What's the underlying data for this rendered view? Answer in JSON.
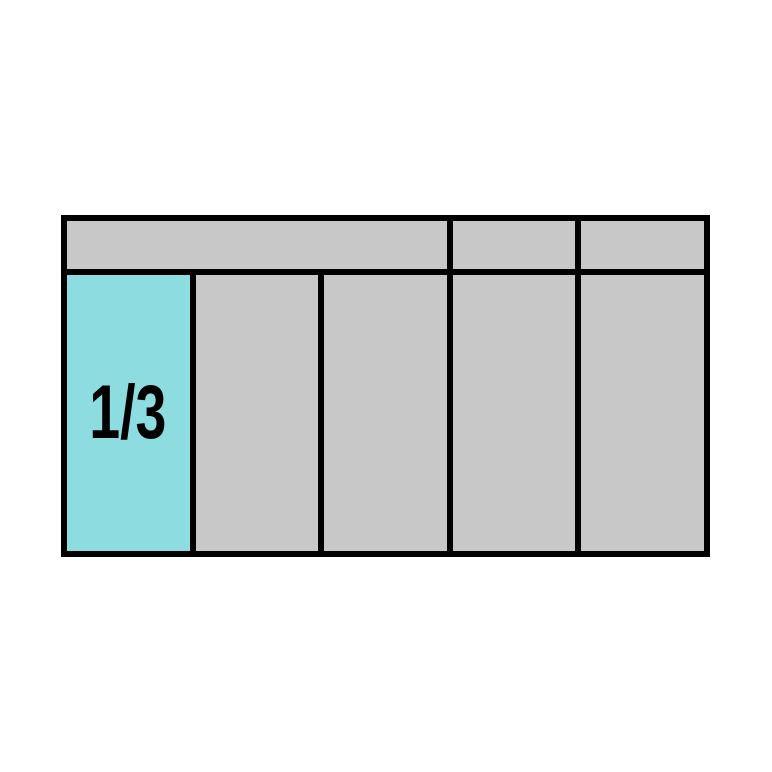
{
  "figure": {
    "fraction_label": "1/3",
    "colors": {
      "frame_black": "#000000",
      "slot_gray": "#C8C8C8",
      "highlight_cyan": "#8DDCE0",
      "page_white": "#FFFFFF",
      "label_black": "#000000"
    },
    "layout": {
      "slot_columns": 5,
      "header_sections": 3,
      "highlighted_slot_index": 0
    }
  }
}
